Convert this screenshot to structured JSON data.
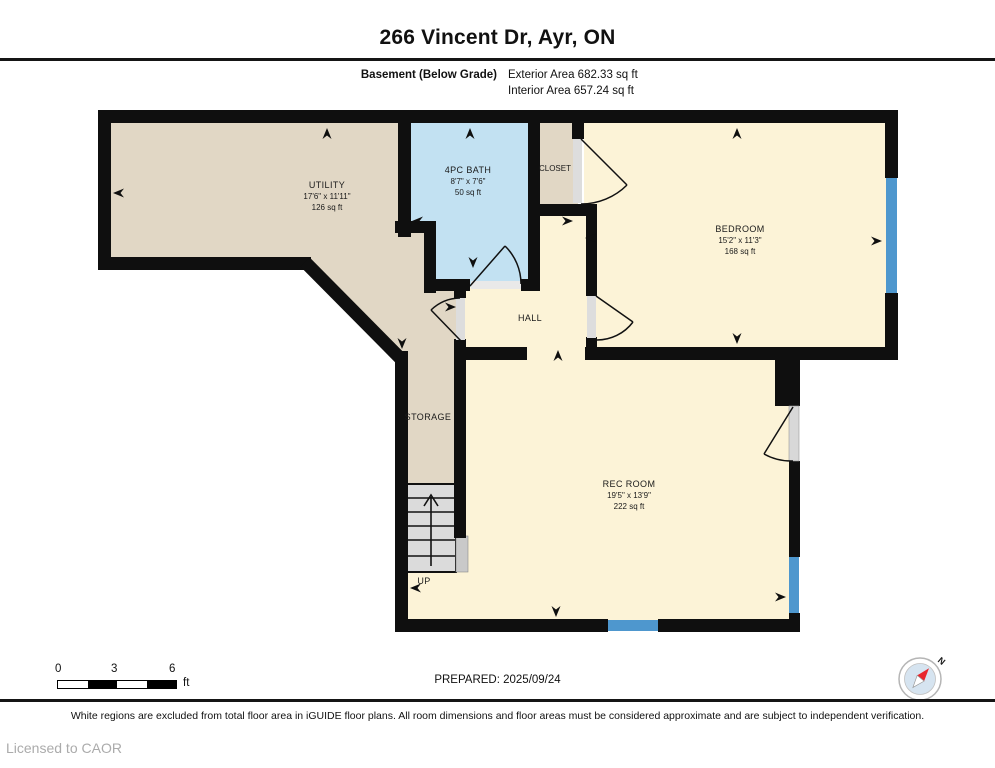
{
  "header": {
    "title": "266 Vincent Dr, Ayr, ON",
    "floor_label": "Basement (Below Grade)",
    "exterior_area": "Exterior Area 682.33 sq ft",
    "interior_area": "Interior Area 657.24 sq ft"
  },
  "rooms": {
    "utility": {
      "name": "UTILITY",
      "dims": "17'6\" x 11'11\"",
      "area": "126 sq ft"
    },
    "bath": {
      "name": "4PC BATH",
      "dims": "8'7\" x 7'6\"",
      "area": "50 sq ft"
    },
    "closet": {
      "name": "CLOSET"
    },
    "bedroom": {
      "name": "BEDROOM",
      "dims": "15'2\" x 11'3\"",
      "area": "168 sq ft"
    },
    "hall": {
      "name": "HALL"
    },
    "storage": {
      "name": "STORAGE"
    },
    "rec_room": {
      "name": "REC ROOM",
      "dims": "19'5\" x 13'9\"",
      "area": "222 sq ft"
    },
    "stairs": {
      "label": "UP"
    }
  },
  "footer": {
    "scale": {
      "ticks": [
        "0",
        "3",
        "6"
      ],
      "unit": "ft"
    },
    "prepared": "PREPARED: 2025/09/24",
    "compass_label": "N",
    "disclaimer": "White regions are excluded from total floor area in iGUIDE floor plans. All room dimensions and floor areas must be considered approximate and are subject to independent verification.",
    "license": "Licensed to CAOR"
  },
  "colors": {
    "wall": "#0f0f0f",
    "room_beige": "#E1D7C5",
    "room_cream": "#FCF3D7",
    "room_bath": "#C2E1F2",
    "window_blue": "#4E97CE",
    "stairs_gray": "#DBDBDB",
    "compass_red": "#E8262D"
  }
}
